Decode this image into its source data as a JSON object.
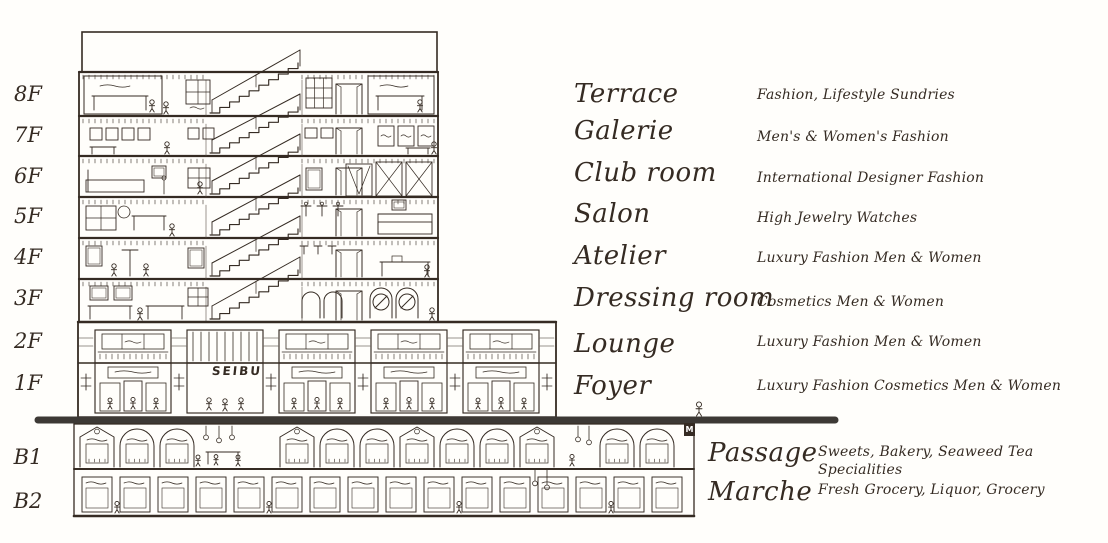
{
  "palette": {
    "ink": "#352b23",
    "ground_bar": "#3d3935",
    "paper": "#fffefb"
  },
  "building": {
    "sign_label": "SEIBU",
    "elevator_mark": "M"
  },
  "directory": {
    "floors": [
      {
        "level": "8F",
        "name": "Terrace",
        "desc": "Fashion, Lifestyle Sundries"
      },
      {
        "level": "7F",
        "name": "Galerie",
        "desc": "Men's & Women's Fashion"
      },
      {
        "level": "6F",
        "name": "Club room",
        "desc": "International Designer Fashion"
      },
      {
        "level": "5F",
        "name": "Salon",
        "desc": "High Jewelry Watches"
      },
      {
        "level": "4F",
        "name": "Atelier",
        "desc": "Luxury Fashion Men & Women"
      },
      {
        "level": "3F",
        "name": "Dressing room",
        "desc": "Cosmetics Men & Women"
      },
      {
        "level": "2F",
        "name": "Lounge",
        "desc": "Luxury Fashion Men & Women"
      },
      {
        "level": "1F",
        "name": "Foyer",
        "desc": "Luxury Fashion Cosmetics Men & Women"
      },
      {
        "level": "B1",
        "name": "Passage",
        "desc": "Sweets, Bakery, Seaweed Tea Specialities"
      },
      {
        "level": "B2",
        "name": "Marche",
        "desc": "Fresh Grocery, Liquor, Grocery"
      }
    ]
  }
}
